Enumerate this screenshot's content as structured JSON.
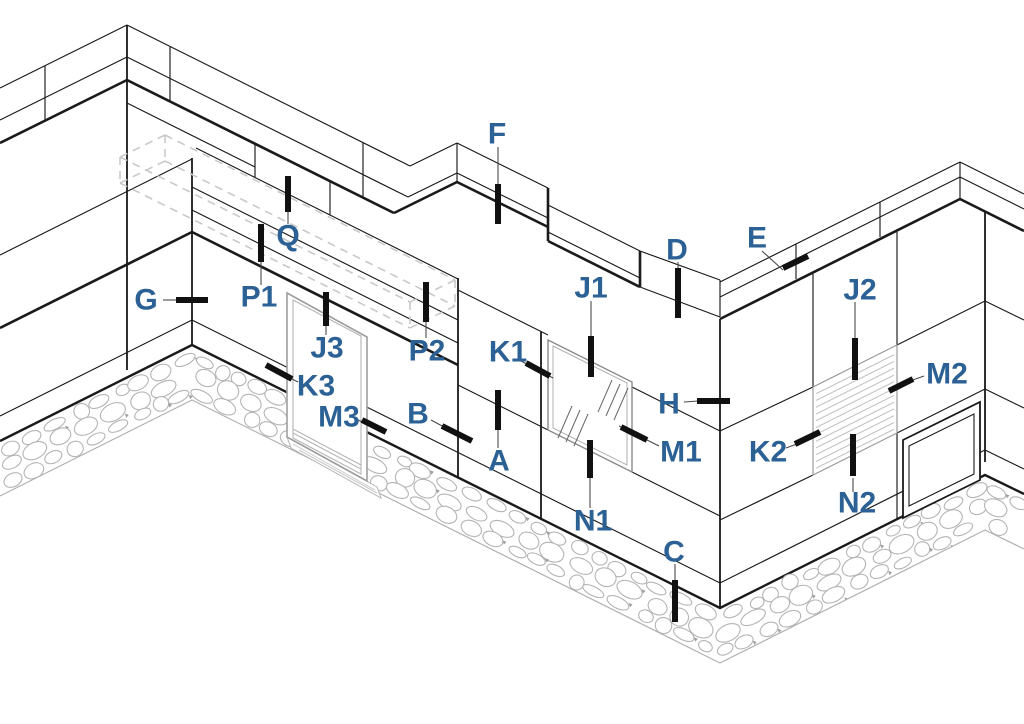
{
  "diagram": {
    "type": "isometric-facade-detail",
    "description": "Axonometric line drawing of a zig-zag tiled facade with coping, door, glazed window, louver panel, blank panel, hidden box (dashed) and rubble stone foundation, annotated with joint reference callouts",
    "colors": {
      "label": "#2b6194",
      "line": "#1a1a1a",
      "hidden_dash": "#c9c9c9",
      "door_gray": "#9e9e9e",
      "frame_gray": "#8a8a8a",
      "hatch_gray": "#c4c4c4",
      "stone_gray": "#b4b4b4",
      "tick": "#111111",
      "leader": "#4a4a4a",
      "background": "#ffffff"
    },
    "elements": [
      "coping",
      "tiled-wall",
      "door",
      "window",
      "louver-panel",
      "blank-panel",
      "foundation-stones",
      "hidden-box"
    ],
    "callouts": [
      {
        "label": "G",
        "x": 146,
        "y": 300,
        "leader": [
          163,
          300,
          178,
          300
        ],
        "tick": [
          176,
          300,
          208,
          300
        ]
      },
      {
        "label": "P1",
        "x": 259,
        "y": 297,
        "leader": [
          261,
          285,
          261,
          260
        ],
        "tick": [
          261,
          262,
          261,
          224
        ]
      },
      {
        "label": "Q",
        "x": 288,
        "y": 236,
        "leader": [
          288,
          224,
          288,
          210
        ],
        "tick": [
          288,
          212,
          288,
          176
        ]
      },
      {
        "label": "J3",
        "x": 327,
        "y": 348,
        "leader": [
          326,
          335,
          326,
          324
        ],
        "tick": [
          326,
          326,
          326,
          292
        ]
      },
      {
        "label": "K3",
        "x": 316,
        "y": 386,
        "leader": [
          298,
          382,
          290,
          378
        ],
        "tick": [
          292,
          379,
          266,
          365
        ]
      },
      {
        "label": "M3",
        "x": 339,
        "y": 417,
        "leader": [
          358,
          420,
          365,
          423
        ],
        "tick": [
          362,
          420,
          386,
          432
        ]
      },
      {
        "label": "P2",
        "x": 427,
        "y": 351,
        "leader": [
          426,
          338,
          426,
          320
        ],
        "tick": [
          426,
          322,
          426,
          282
        ]
      },
      {
        "label": "B",
        "x": 418,
        "y": 414,
        "leader": [
          431,
          420,
          444,
          427
        ],
        "tick": [
          442,
          426,
          472,
          441
        ]
      },
      {
        "label": "A",
        "x": 499,
        "y": 461,
        "leader": [
          498,
          448,
          498,
          428
        ],
        "tick": [
          498,
          430,
          498,
          390
        ]
      },
      {
        "label": "K1",
        "x": 508,
        "y": 352,
        "leader": [
          521,
          361,
          553,
          378
        ],
        "tick": [
          526,
          363,
          550,
          376
        ]
      },
      {
        "label": "J1",
        "x": 591,
        "y": 288,
        "leader": [
          591,
          301,
          591,
          338
        ],
        "tick": [
          591,
          336,
          591,
          377
        ]
      },
      {
        "label": "M1",
        "x": 681,
        "y": 452,
        "leader": [
          659,
          446,
          619,
          426
        ],
        "tick": [
          647,
          440,
          621,
          427
        ]
      },
      {
        "label": "N1",
        "x": 593,
        "y": 521,
        "leader": [
          590,
          508,
          590,
          476
        ],
        "tick": [
          590,
          478,
          590,
          440
        ]
      },
      {
        "label": "C",
        "x": 674,
        "y": 552,
        "leader": [
          675,
          564,
          675,
          582
        ],
        "tick": [
          675,
          580,
          675,
          622
        ]
      },
      {
        "label": "F",
        "x": 497,
        "y": 134,
        "leader": [
          498,
          147,
          498,
          186
        ],
        "tick": [
          498,
          184,
          498,
          224
        ]
      },
      {
        "label": "D",
        "x": 677,
        "y": 250,
        "leader": [
          678,
          262,
          678,
          270
        ],
        "tick": [
          678,
          268,
          678,
          318
        ]
      },
      {
        "label": "E",
        "x": 757,
        "y": 238,
        "leader": [
          762,
          251,
          783,
          270
        ],
        "tick": [
          783,
          268,
          808,
          256
        ]
      },
      {
        "label": "H",
        "x": 669,
        "y": 404,
        "leader": [
          684,
          402,
          698,
          401
        ],
        "tick": [
          697,
          401,
          730,
          401
        ]
      },
      {
        "label": "J2",
        "x": 860,
        "y": 290,
        "leader": [
          855,
          302,
          855,
          340
        ],
        "tick": [
          855,
          338,
          855,
          380
        ]
      },
      {
        "label": "K2",
        "x": 768,
        "y": 452,
        "leader": [
          786,
          448,
          797,
          444
        ],
        "tick": [
          795,
          444,
          820,
          432
        ]
      },
      {
        "label": "M2",
        "x": 947,
        "y": 374,
        "leader": [
          924,
          376,
          910,
          381
        ],
        "tick": [
          913,
          379,
          889,
          391
        ]
      },
      {
        "label": "N2",
        "x": 857,
        "y": 503,
        "leader": [
          853,
          492,
          853,
          478
        ],
        "tick": [
          853,
          476,
          853,
          434
        ]
      }
    ]
  }
}
